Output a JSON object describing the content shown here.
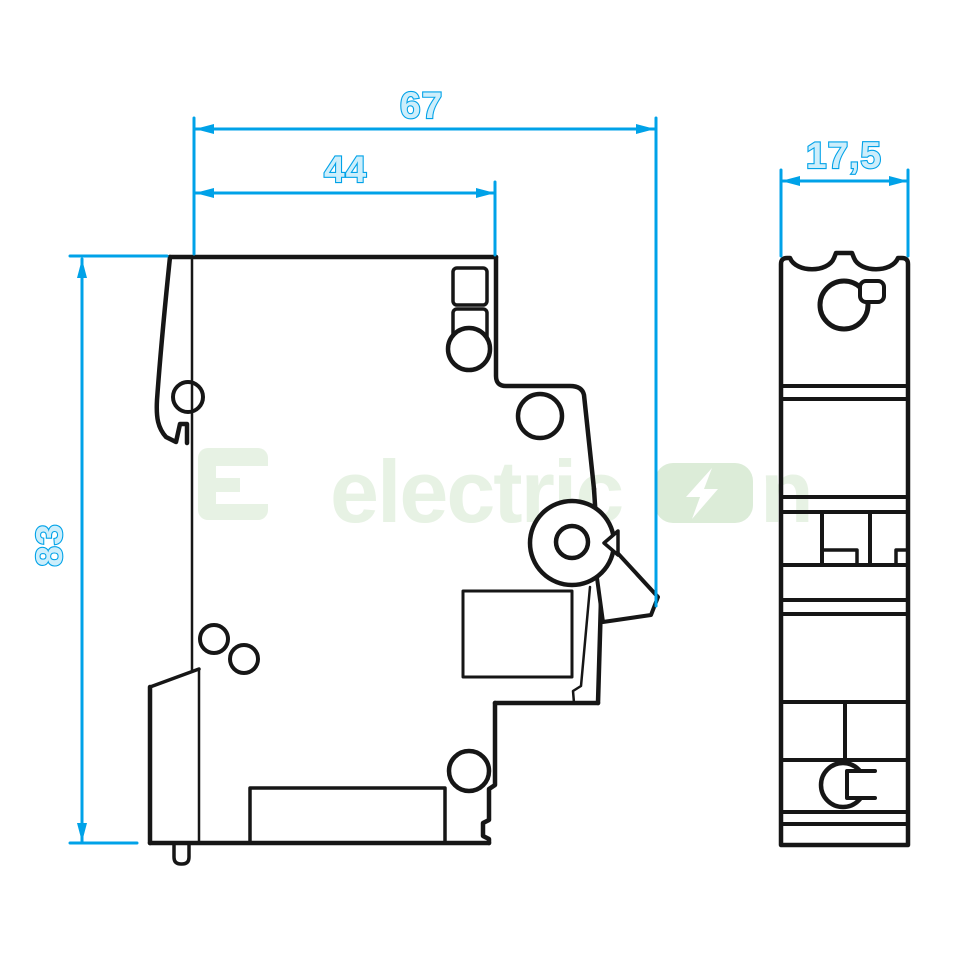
{
  "drawing": {
    "type": "technical-dimension-drawing",
    "subject": "miniature-circuit-breaker",
    "views": {
      "side_view_name": "side-profile-view",
      "front_view_name": "front-narrow-view"
    }
  },
  "dimensions": {
    "width_total": "67",
    "width_upper": "44",
    "height": "83",
    "depth": "17,5"
  },
  "watermark": {
    "brand_prefix": "electric",
    "brand_suffix": "n",
    "logo_icon": "electricon-logo",
    "bolt_icon": "lightning-bolt"
  },
  "colors": {
    "dimension": "#00a2e8",
    "dimension_fill": "#cdeefb",
    "ink": "#161616",
    "watermark": "#e7f2e4",
    "watermark_badge": "#dcecd8",
    "background": "#ffffff"
  }
}
